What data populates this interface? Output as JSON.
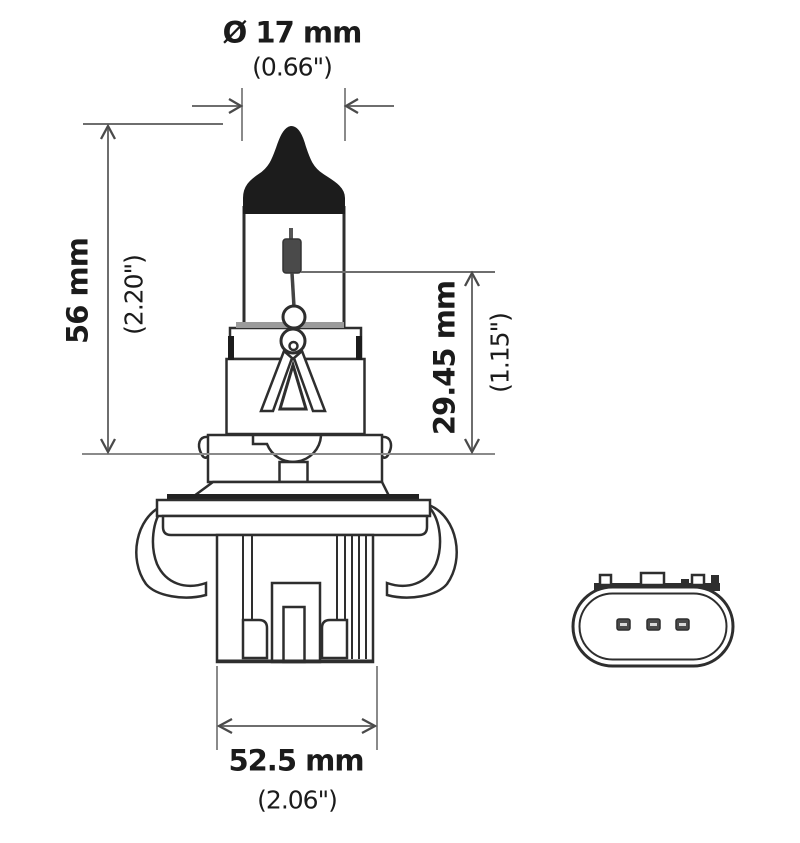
{
  "diagram": {
    "dimensions": {
      "bulb_diameter": {
        "metric": "Ø 17 mm",
        "imperial": "(0.66\")"
      },
      "overall_length": {
        "metric": "56 mm",
        "imperial": "(2.20\")"
      },
      "light_center_length": {
        "metric": "29.45 mm",
        "imperial": "(1.15\")"
      },
      "base_width": {
        "metric": "52.5 mm",
        "imperial": "(2.06\")"
      }
    },
    "colors": {
      "background": "#ffffff",
      "outline": "#2e2e2e",
      "fill_dark": "#1c1c1c",
      "dimension_line": "#6e6e6e",
      "reference_line": "#8a8a8a",
      "text": "#1b1b1b"
    }
  }
}
